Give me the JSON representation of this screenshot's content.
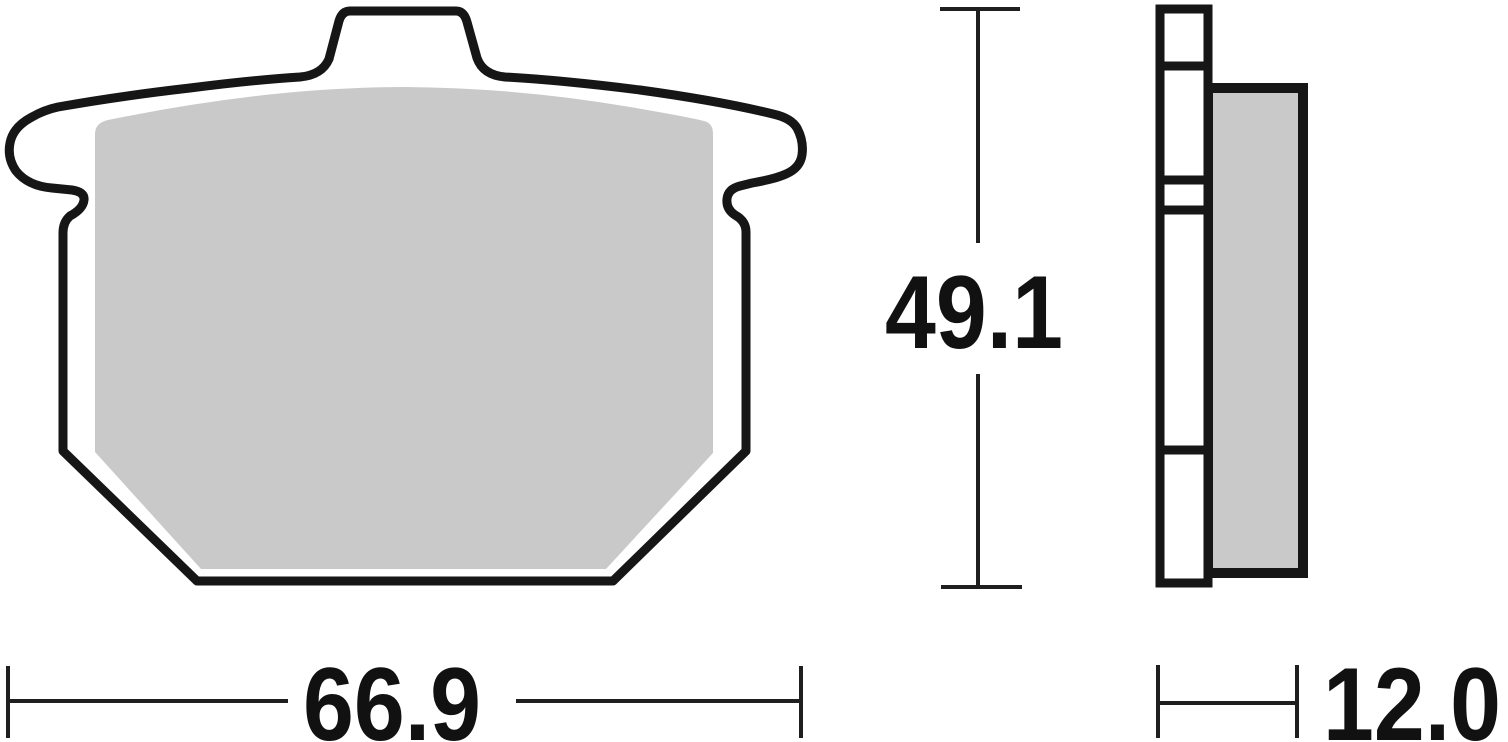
{
  "dimensions": {
    "width": "66.9",
    "height": "49.1",
    "thickness": "12.0"
  },
  "colors": {
    "outline": "#161616",
    "dimline": "#1f1f1f",
    "text": "#111111",
    "padFill": "#c9c9c9",
    "background": "#ffffff"
  }
}
